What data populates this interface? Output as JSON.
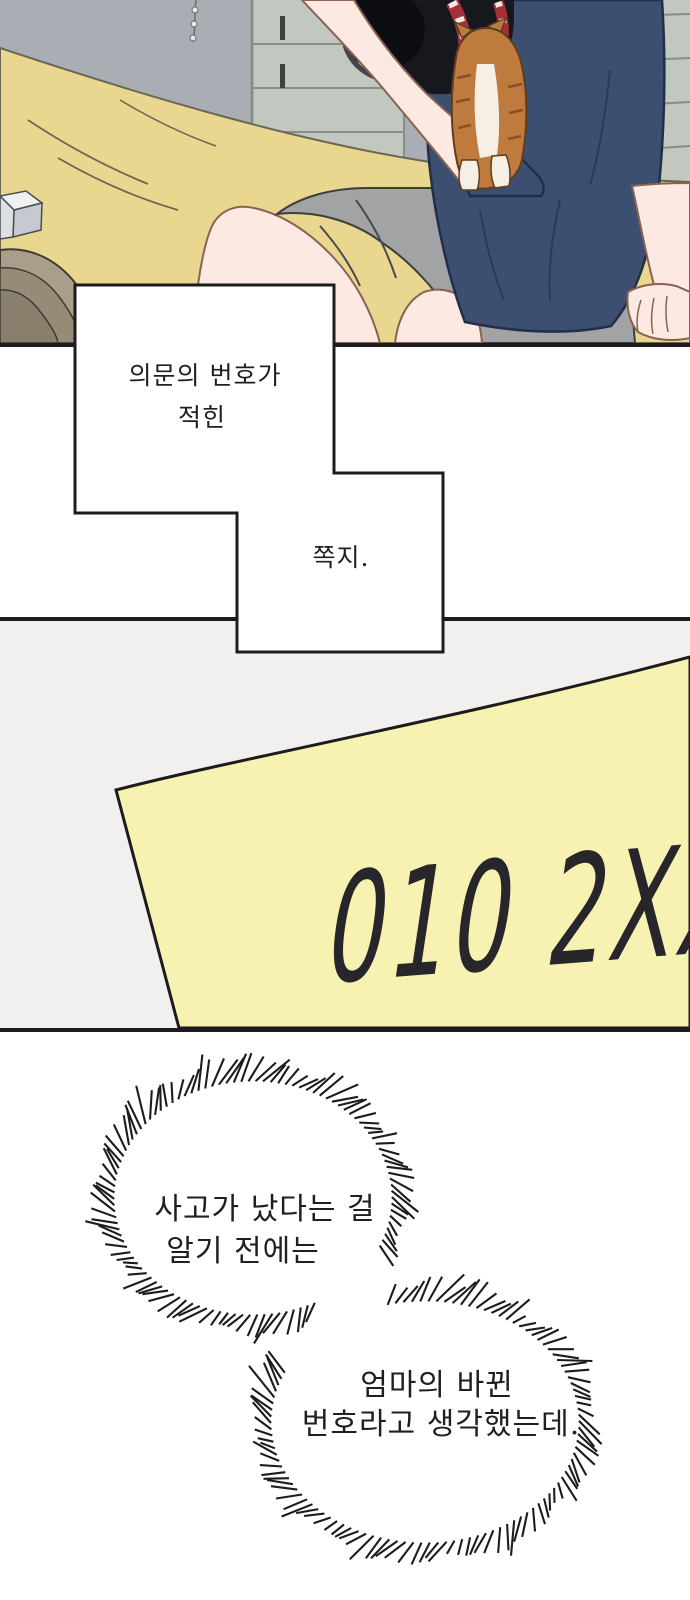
{
  "narration_box_1": {
    "line1": "의문의 번호가",
    "line2": "적힌"
  },
  "narration_box_2": {
    "line1": "쪽지."
  },
  "note": {
    "handwriting": "010 2XX"
  },
  "bubble_1": {
    "line1": "사고가 났다는 걸",
    "line2": "알기 전에는"
  },
  "bubble_2": {
    "line1": "엄마의 바뀐",
    "line2": "번호라고 생각했는데."
  },
  "colors": {
    "ink": "#1c1c1c",
    "page_bg": "#ffffff",
    "panel2_bg": "#f1f0ee",
    "box_white": "#ffffff",
    "text": "#1f1f1f",
    "note_yellow": "#f8f2b2",
    "note_ink": "#26262b",
    "wall": "#a9aeb4",
    "shutter": "#c2c7c0",
    "shutter_line": "#878d87",
    "shutter_dark": "#3e4341",
    "blanket": "#e9d78f",
    "blanket_line": "#6b6553",
    "skin": "#fce9e1",
    "skin_line": "#8a6152",
    "shirt": "#3d4f70",
    "shirt_line": "#232f49",
    "shirt_fold": "#2b3a58",
    "shorts": "#a2a3a5",
    "shorts_line": "#3e3e40",
    "cat": "#bf7a3d",
    "cat_stripe": "#8a4f22",
    "cat_line": "#5f3d1e",
    "cat_white": "#f6efe4",
    "camera": "#17181d",
    "camera_ring": "#43464d",
    "strap_red": "#a82f38",
    "strap_white": "#f0e9e4",
    "wood_1": "#a99e8a",
    "wood_2": "#958b77",
    "wood_3": "#887f6c"
  }
}
